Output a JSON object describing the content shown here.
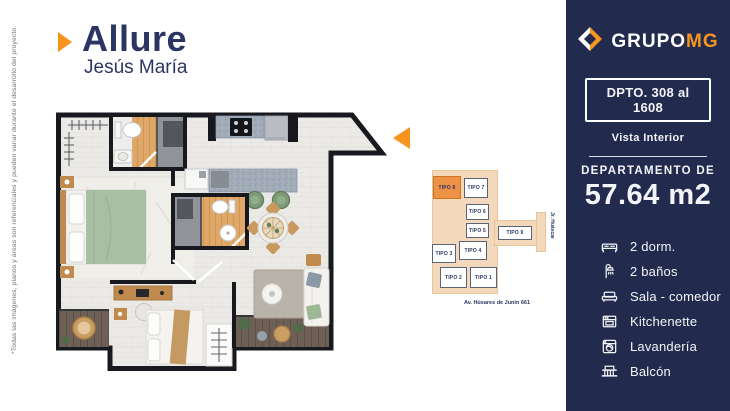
{
  "header": {
    "title": "Allure",
    "subtitle": "Jesús María"
  },
  "disclaimer": "*Todas las imágenes, planos y áreas son referenciales y pueden variar durante el desarrollo del proyecto.",
  "colors": {
    "navy": "#222B4E",
    "title_navy": "#2B3563",
    "orange": "#F7941E",
    "keyplan_peach": "#F3D8BB",
    "keyplan_highlight": "#EE9247"
  },
  "sidebar": {
    "brand": {
      "primary": "GRUPO",
      "secondary": "MG",
      "logo_icon": "grupomg-diamond-icon"
    },
    "unit_range": "DPTO. 308 al 1608",
    "view_label": "Vista Interior",
    "area_label": "DEPARTAMENTO DE",
    "area_value": "57.64 m2",
    "amenities": [
      {
        "icon": "bed-icon",
        "label": "2 dorm."
      },
      {
        "icon": "shower-icon",
        "label": "2 baños"
      },
      {
        "icon": "sofa-icon",
        "label": "Sala - comedor"
      },
      {
        "icon": "kitchen-icon",
        "label": "Kitchenette"
      },
      {
        "icon": "washer-icon",
        "label": "Lavandería"
      },
      {
        "icon": "balcony-icon",
        "label": "Balcón"
      }
    ]
  },
  "keyplan": {
    "units": [
      {
        "id": "tipo-8",
        "label": "TIPO 8",
        "highlighted": true
      },
      {
        "id": "tipo-7",
        "label": "TIPO 7",
        "highlighted": false
      },
      {
        "id": "tipo-6",
        "label": "TIPO 6",
        "highlighted": false
      },
      {
        "id": "tipo-5",
        "label": "TIPO 5",
        "highlighted": false
      },
      {
        "id": "tipo-9",
        "label": "TIPO 9",
        "highlighted": false
      },
      {
        "id": "tipo-4",
        "label": "TIPO 4",
        "highlighted": false
      },
      {
        "id": "tipo-3",
        "label": "TIPO 3",
        "highlighted": false
      },
      {
        "id": "tipo-2",
        "label": "TIPO 2",
        "highlighted": false
      },
      {
        "id": "tipo-1",
        "label": "TIPO 1",
        "highlighted": false
      }
    ],
    "street_bottom": "Av. Húsares de Junín 661",
    "street_right": "Jr. Huáscar"
  }
}
